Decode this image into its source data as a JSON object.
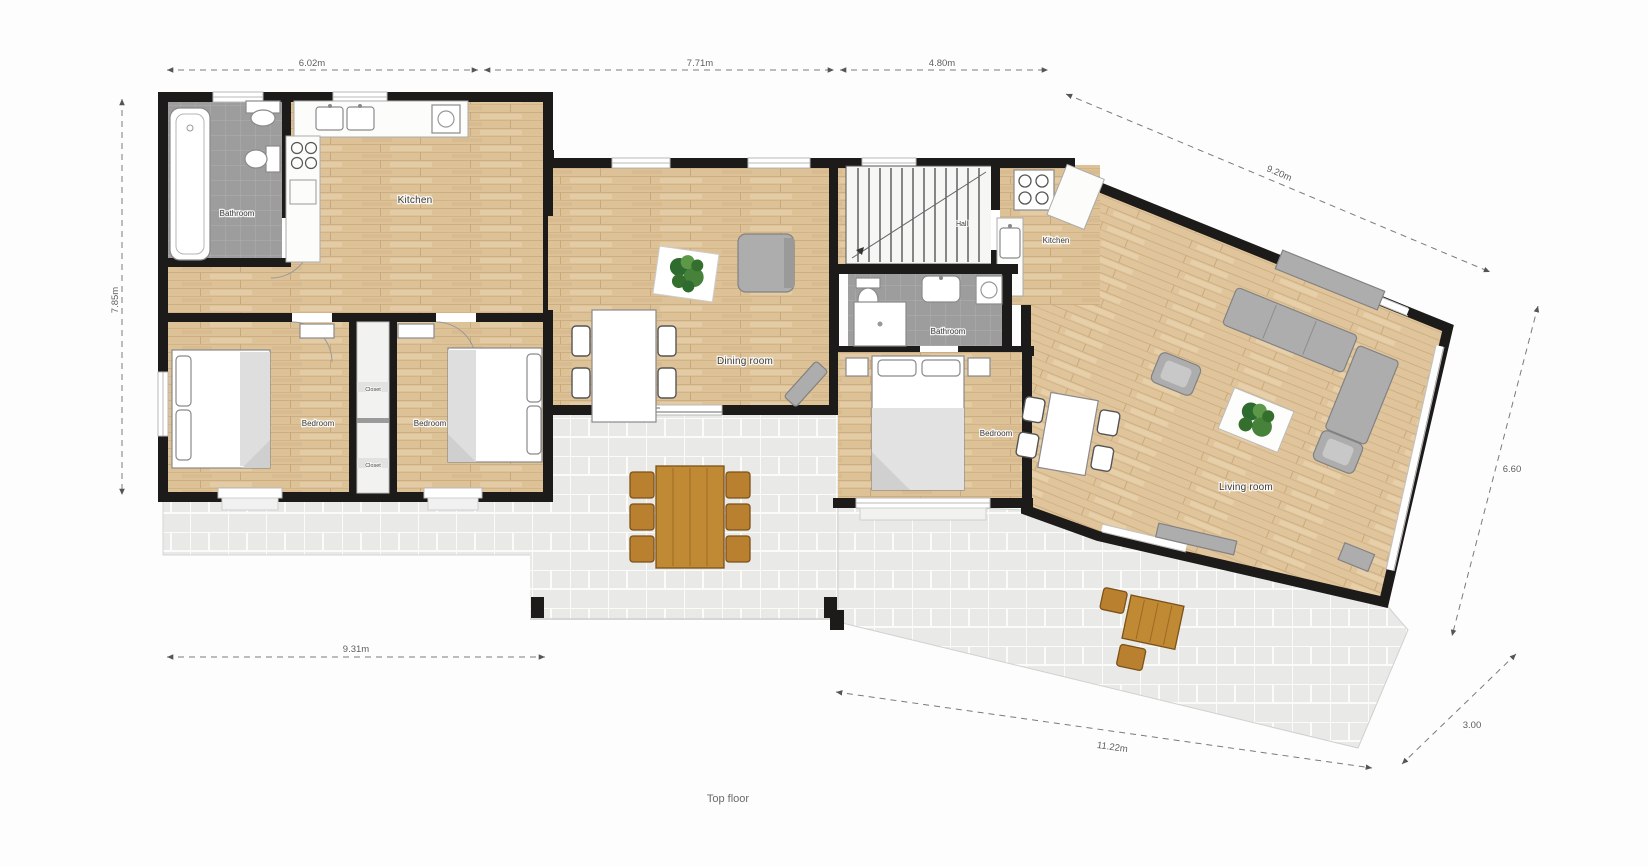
{
  "caption": "Top floor",
  "rooms": {
    "bathroom_left": "Bathroom",
    "kitchen_left": "Kitchen",
    "bedroom_left_1": "Bedroom",
    "bedroom_left_2": "Bedroom",
    "closet_top": "Closet",
    "closet_bottom": "Closet",
    "dining_room": "Dining room",
    "hall": "Hall",
    "kitchen_right": "Kitchen",
    "bathroom_right": "Bathroom",
    "bedroom_right": "Bedroom",
    "living_room": "Living room"
  },
  "dimensions": {
    "top_left": "6.02m",
    "top_middle": "7.71m",
    "top_right": "4.80m",
    "upper_right_diagonal": "9.20m",
    "left_side": "7.85m",
    "right_side": "6.60",
    "lower_right_diagonal": "3.00",
    "bottom_terrace": "11.22m",
    "bottom_left": "9.31m"
  },
  "colors": {
    "wall": "#1d1b19",
    "wood_floor": "#ddc197",
    "bathroom_tile": "#9d9d9d",
    "terrace_tile": "#e9e9e8",
    "outdoor_furniture": "#b9802f",
    "plant_green": "#3f7d35",
    "sofa_gray": "#adadad"
  }
}
